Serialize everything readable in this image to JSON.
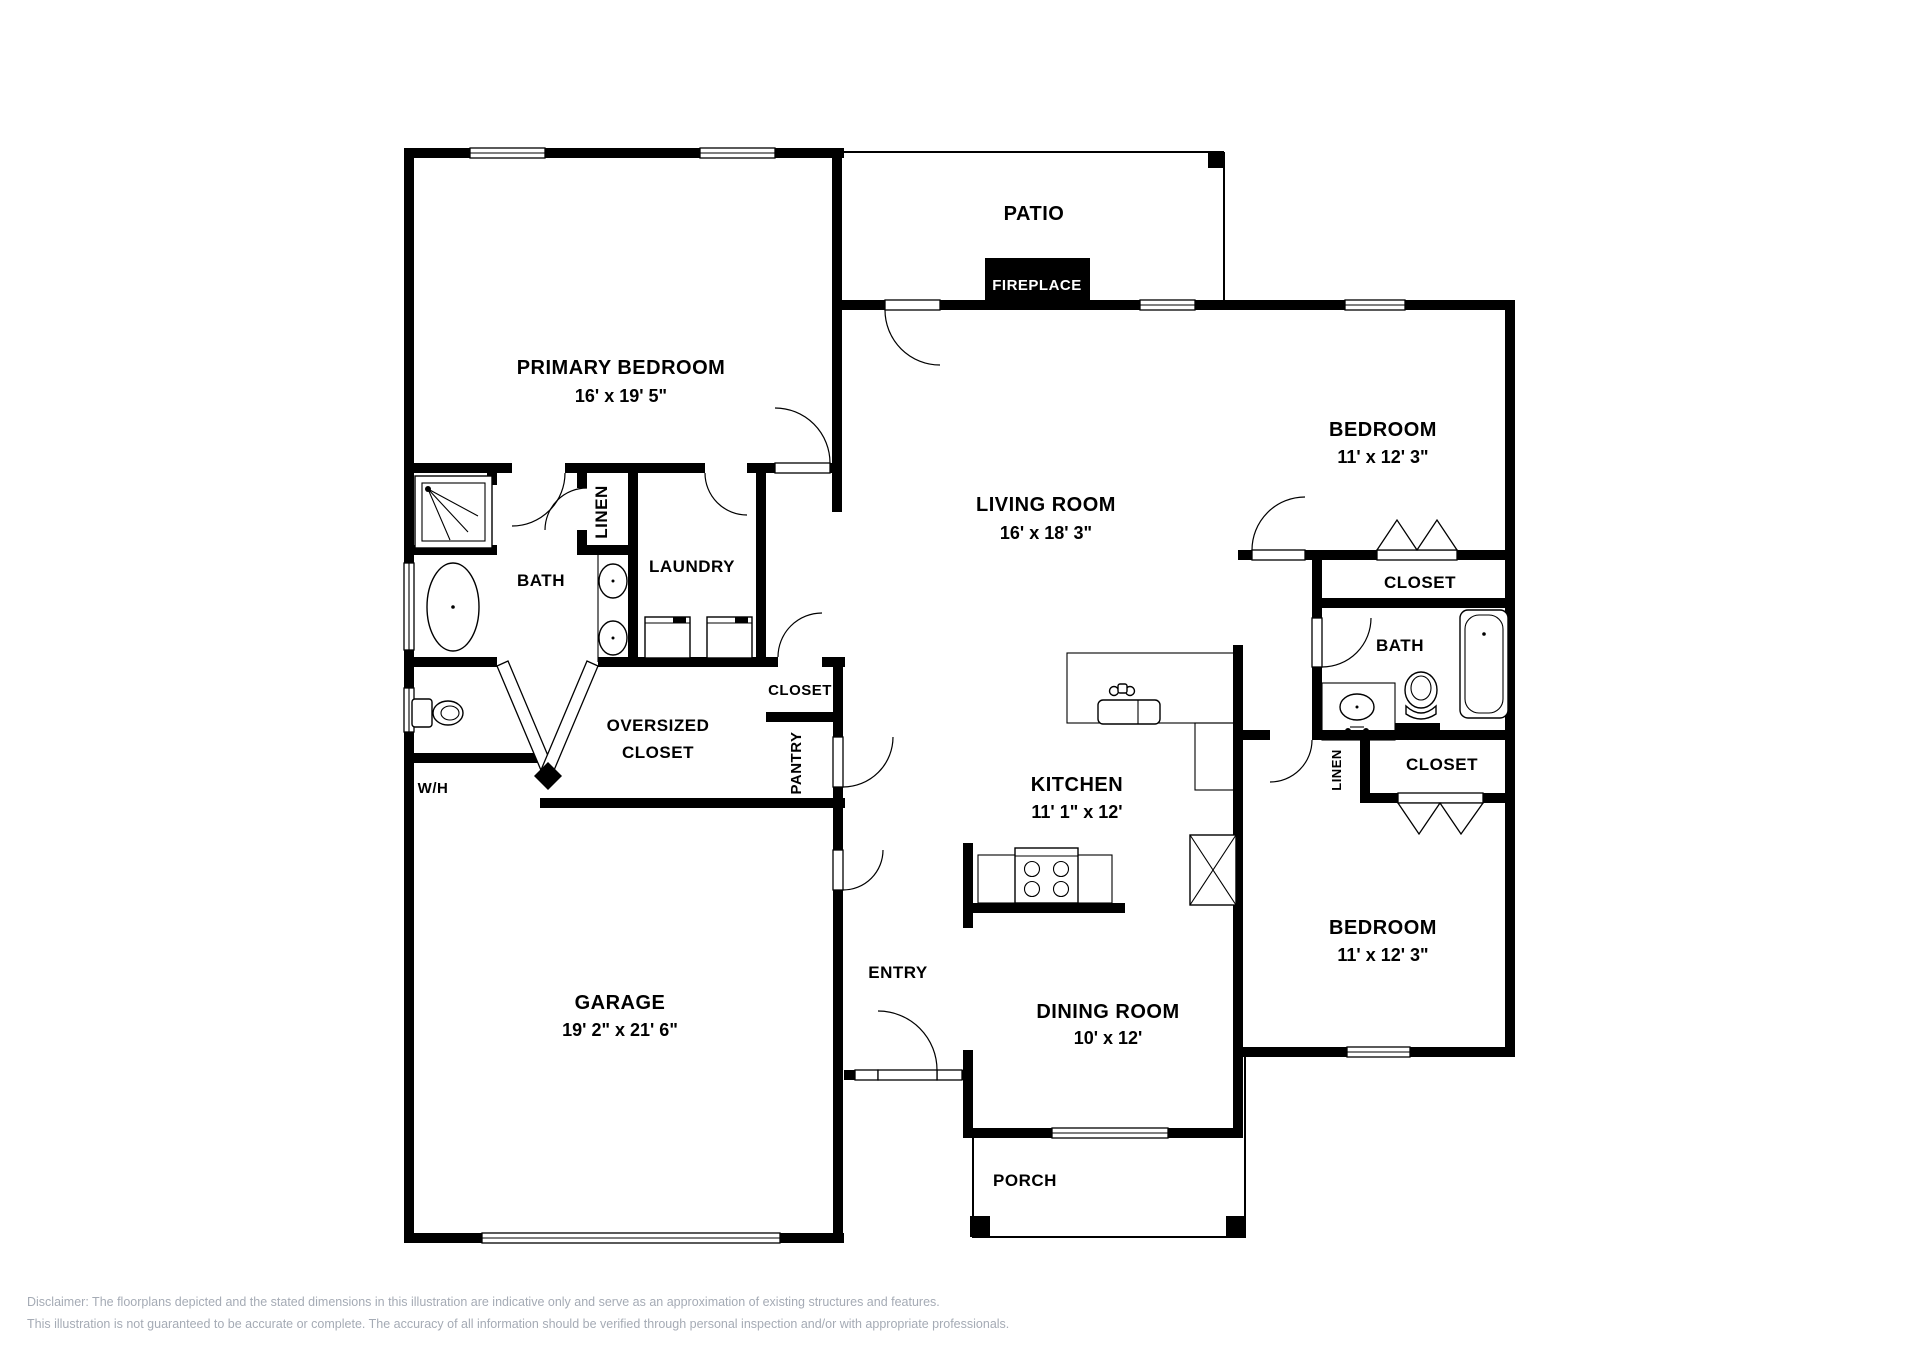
{
  "plan": {
    "outdoor": {
      "patio": "PATIO",
      "porch": "PORCH"
    },
    "fireplace": "FIREPLACE",
    "rooms": {
      "primary_bedroom": {
        "name": "PRIMARY BEDROOM",
        "dims": "16' x 19' 5\""
      },
      "living_room": {
        "name": "LIVING ROOM",
        "dims": "16' x 18' 3\""
      },
      "bedroom_top": {
        "name": "BEDROOM",
        "dims": "11' x 12' 3\""
      },
      "bedroom_bottom": {
        "name": "BEDROOM",
        "dims": "11' x 12' 3\""
      },
      "kitchen": {
        "name": "KITCHEN",
        "dims": "11' 1\" x 12'"
      },
      "dining_room": {
        "name": "DINING ROOM",
        "dims": "10' x 12'"
      },
      "garage": {
        "name": "GARAGE",
        "dims": "19' 2\" x 21' 6\""
      }
    },
    "areas": {
      "bath_left": "BATH",
      "bath_right": "BATH",
      "laundry": "LAUNDRY",
      "linen_left": "LINEN",
      "linen_right": "LINEN",
      "closet_center": "CLOSET",
      "closet_right_top": "CLOSET",
      "closet_right_bottom": "CLOSET",
      "pantry": "PANTRY",
      "oversized_closet_line1": "OVERSIZED",
      "oversized_closet_line2": "CLOSET",
      "water_heater": "W/H",
      "entry": "ENTRY"
    },
    "fixtures": [
      "shower",
      "bathtub",
      "toilet",
      "double-sink",
      "washer",
      "dryer",
      "kitchen-sink",
      "stove",
      "refrigerator",
      "vanity-sink"
    ],
    "colors": {
      "walls": "#000000",
      "labels": "#000000",
      "fireplace_bg": "#000000",
      "fireplace_text": "#ffffff",
      "disclaimer_text": "#a5abb5",
      "background": "#ffffff"
    }
  },
  "footer": {
    "line1": "Disclaimer: The floorplans depicted and the stated dimensions in this illustration are indicative only and serve as an approximation of existing structures and features.",
    "line2": "This illustration is not guaranteed to be accurate or complete. The accuracy of all information should be verified through personal inspection and/or with appropriate professionals."
  }
}
